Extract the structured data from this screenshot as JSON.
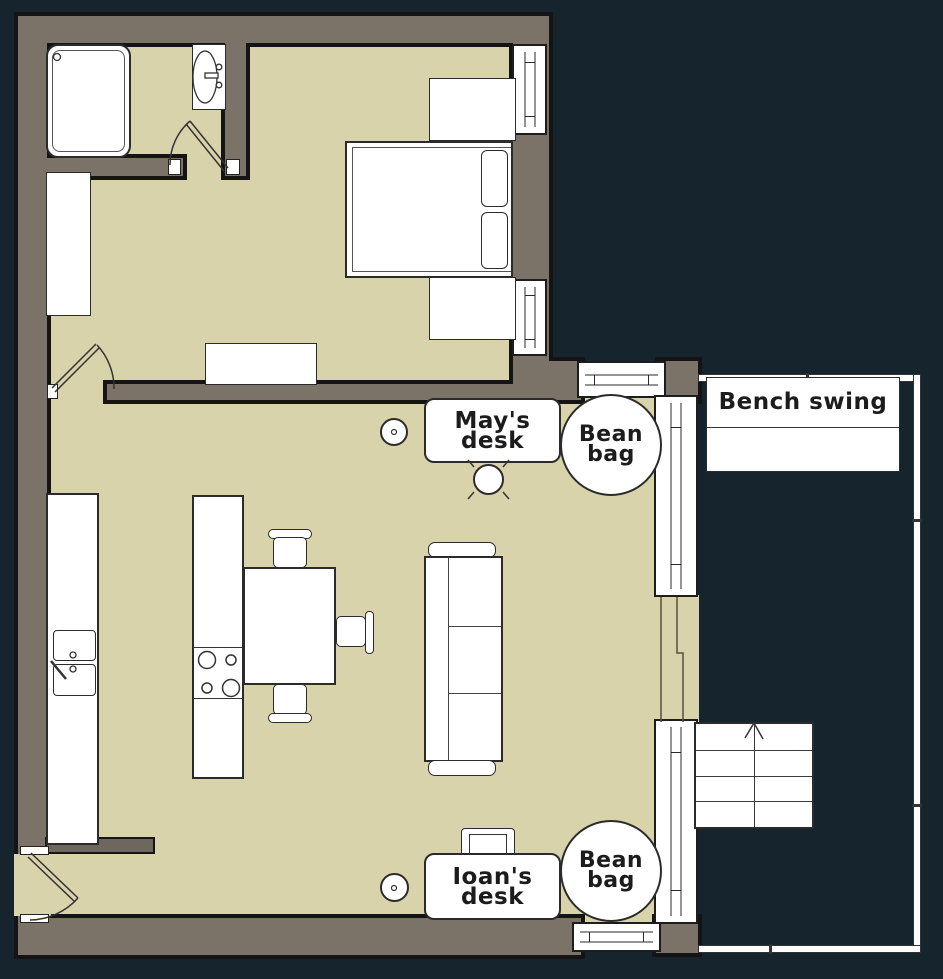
{
  "plan": {
    "labels": {
      "mays_desk": "May's desk",
      "bean_bag": "Bean\nbag",
      "bench_swing": "Bench swing",
      "ioans_desk": "Ioan's desk"
    },
    "colors": {
      "background": "#16242e",
      "floor": "#d9d3ab",
      "wall": "#7b7268",
      "wall_dark": "#6e675d",
      "outline": "#141414",
      "furniture_fill": "#ffffff"
    },
    "rooms": [
      "bathroom",
      "bedroom",
      "living-kitchen",
      "deck"
    ]
  }
}
